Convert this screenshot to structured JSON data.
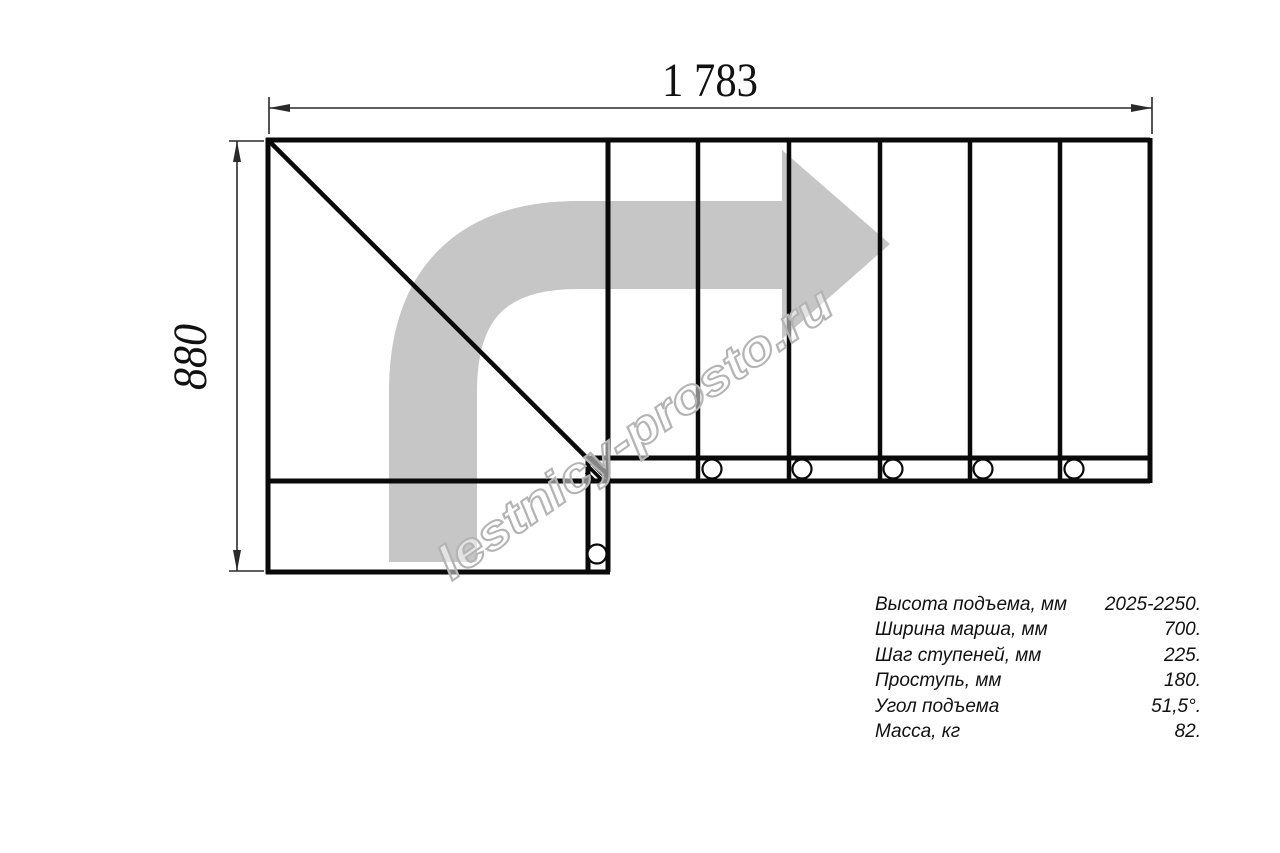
{
  "colors": {
    "line": "#0a0a0a",
    "arrow_fill": "#c6c6c6",
    "watermark": "#b4b4b4",
    "background": "#ffffff"
  },
  "dimensions": {
    "width_mm": "1 783",
    "height_mm": "880"
  },
  "watermark": {
    "text": "lestnicy-prosto.ru"
  },
  "specs": {
    "rows": [
      {
        "label": "Высота подъема, мм",
        "value": "2025-2250."
      },
      {
        "label": "Ширина марша, мм",
        "value": "700."
      },
      {
        "label": "Шаг ступеней, мм",
        "value": "225."
      },
      {
        "label": "Проступь, мм",
        "value": "180."
      },
      {
        "label": "Угол подъема",
        "value": "51,5°."
      },
      {
        "label": "Масса, кг",
        "value": "82."
      }
    ]
  }
}
